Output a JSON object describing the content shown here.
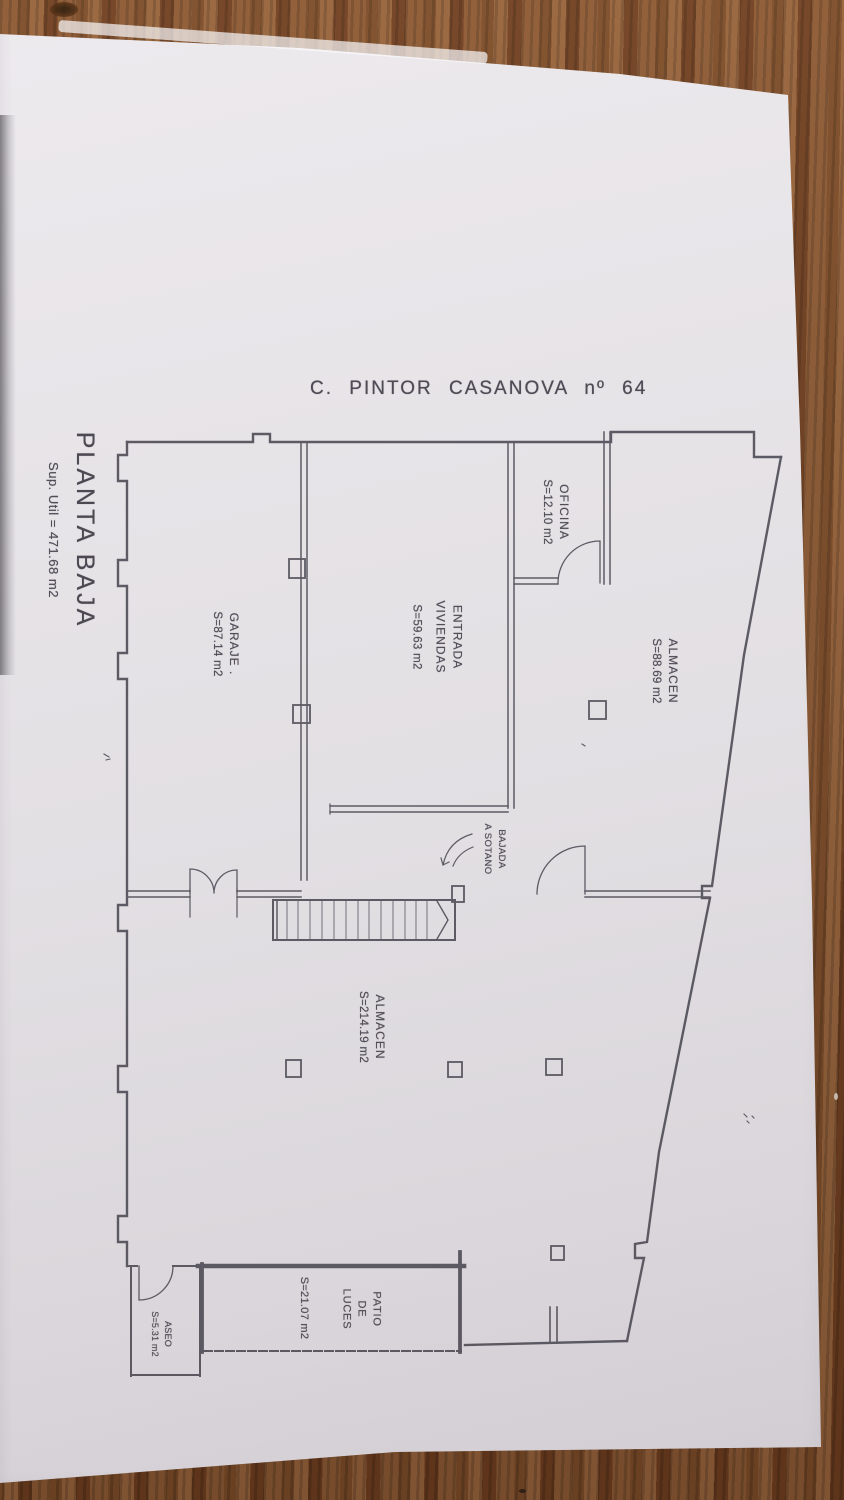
{
  "document": {
    "street_title": "C. PINTOR CASANOVA nº 64",
    "floor_label": "PLANTA BAJA",
    "total_area": "Sup. Util = 471.68 m2"
  },
  "rooms": {
    "garaje": {
      "name": "GARAJE .",
      "area": "S=87.14 m2"
    },
    "entrada": {
      "line1": "ENTRADA",
      "line2": "VIVIENDAS",
      "area": "S=59.63 m2"
    },
    "oficina": {
      "name": "OFICINA",
      "area": "S=12.10 m2"
    },
    "almacen_superior": {
      "name": "ALMACEN",
      "area": "S=88.69 m2"
    },
    "almacen_inferior": {
      "name": "ALMACEN",
      "area": "S=214.19 m2"
    },
    "bajada": {
      "line1": "BAJADA",
      "line2": "A SOTANO"
    },
    "patio": {
      "line1": "PATIO",
      "line2": "DE",
      "line3": "LUCES",
      "area": "S=21.07 m2"
    },
    "aseo": {
      "name": "ASEO",
      "area": "S=5.31 m2"
    }
  }
}
